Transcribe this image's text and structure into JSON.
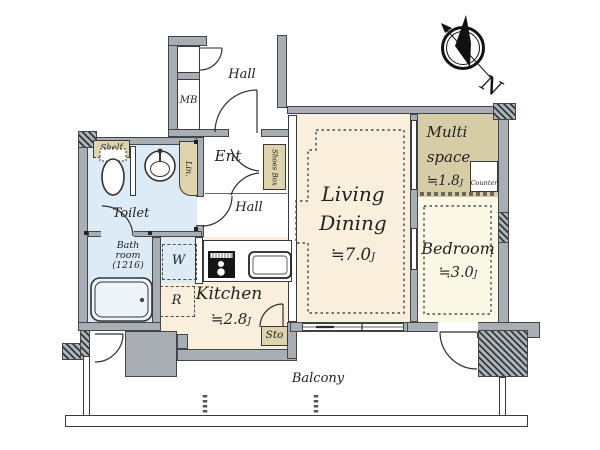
{
  "compass": {
    "north": "N"
  },
  "common_area": {
    "hall": "Hall",
    "meter_box": "MB"
  },
  "entrance": {
    "label": "Ent",
    "shoes_box": "Shoes Box",
    "hall": "Hall"
  },
  "washroom": {
    "toilet": "Toilet",
    "shelf": "Shelf",
    "linen": "Lin.",
    "washer": "W"
  },
  "bathroom": {
    "name_line1": "Bath",
    "name_line2": "room",
    "name_line3": "(1216)"
  },
  "kitchen": {
    "name": "Kitchen",
    "size": "≒2.8",
    "size_unit": "J",
    "fridge": "R",
    "storage": "Sto"
  },
  "living_dining": {
    "name_line1": "Living",
    "name_line2": "Dining",
    "size": "≒7.0",
    "size_unit": "J"
  },
  "multi_space": {
    "name_line1": "Multi",
    "name_line2": "space",
    "size": "≒1.8",
    "size_unit": "J",
    "counter": "Counter"
  },
  "bedroom": {
    "name": "Bedroom",
    "size": "≒3.0",
    "size_unit": "J"
  },
  "balcony": {
    "name": "Balcony"
  },
  "colors": {
    "wall_gray": "#a9aeb4",
    "floor_cream": "#faeedc",
    "floor_pale_cream": "#fcf8e6",
    "floor_khaki": "#d6cda6",
    "fixture_beige": "#ded4ac",
    "floor_blue": "#dcebf5"
  }
}
